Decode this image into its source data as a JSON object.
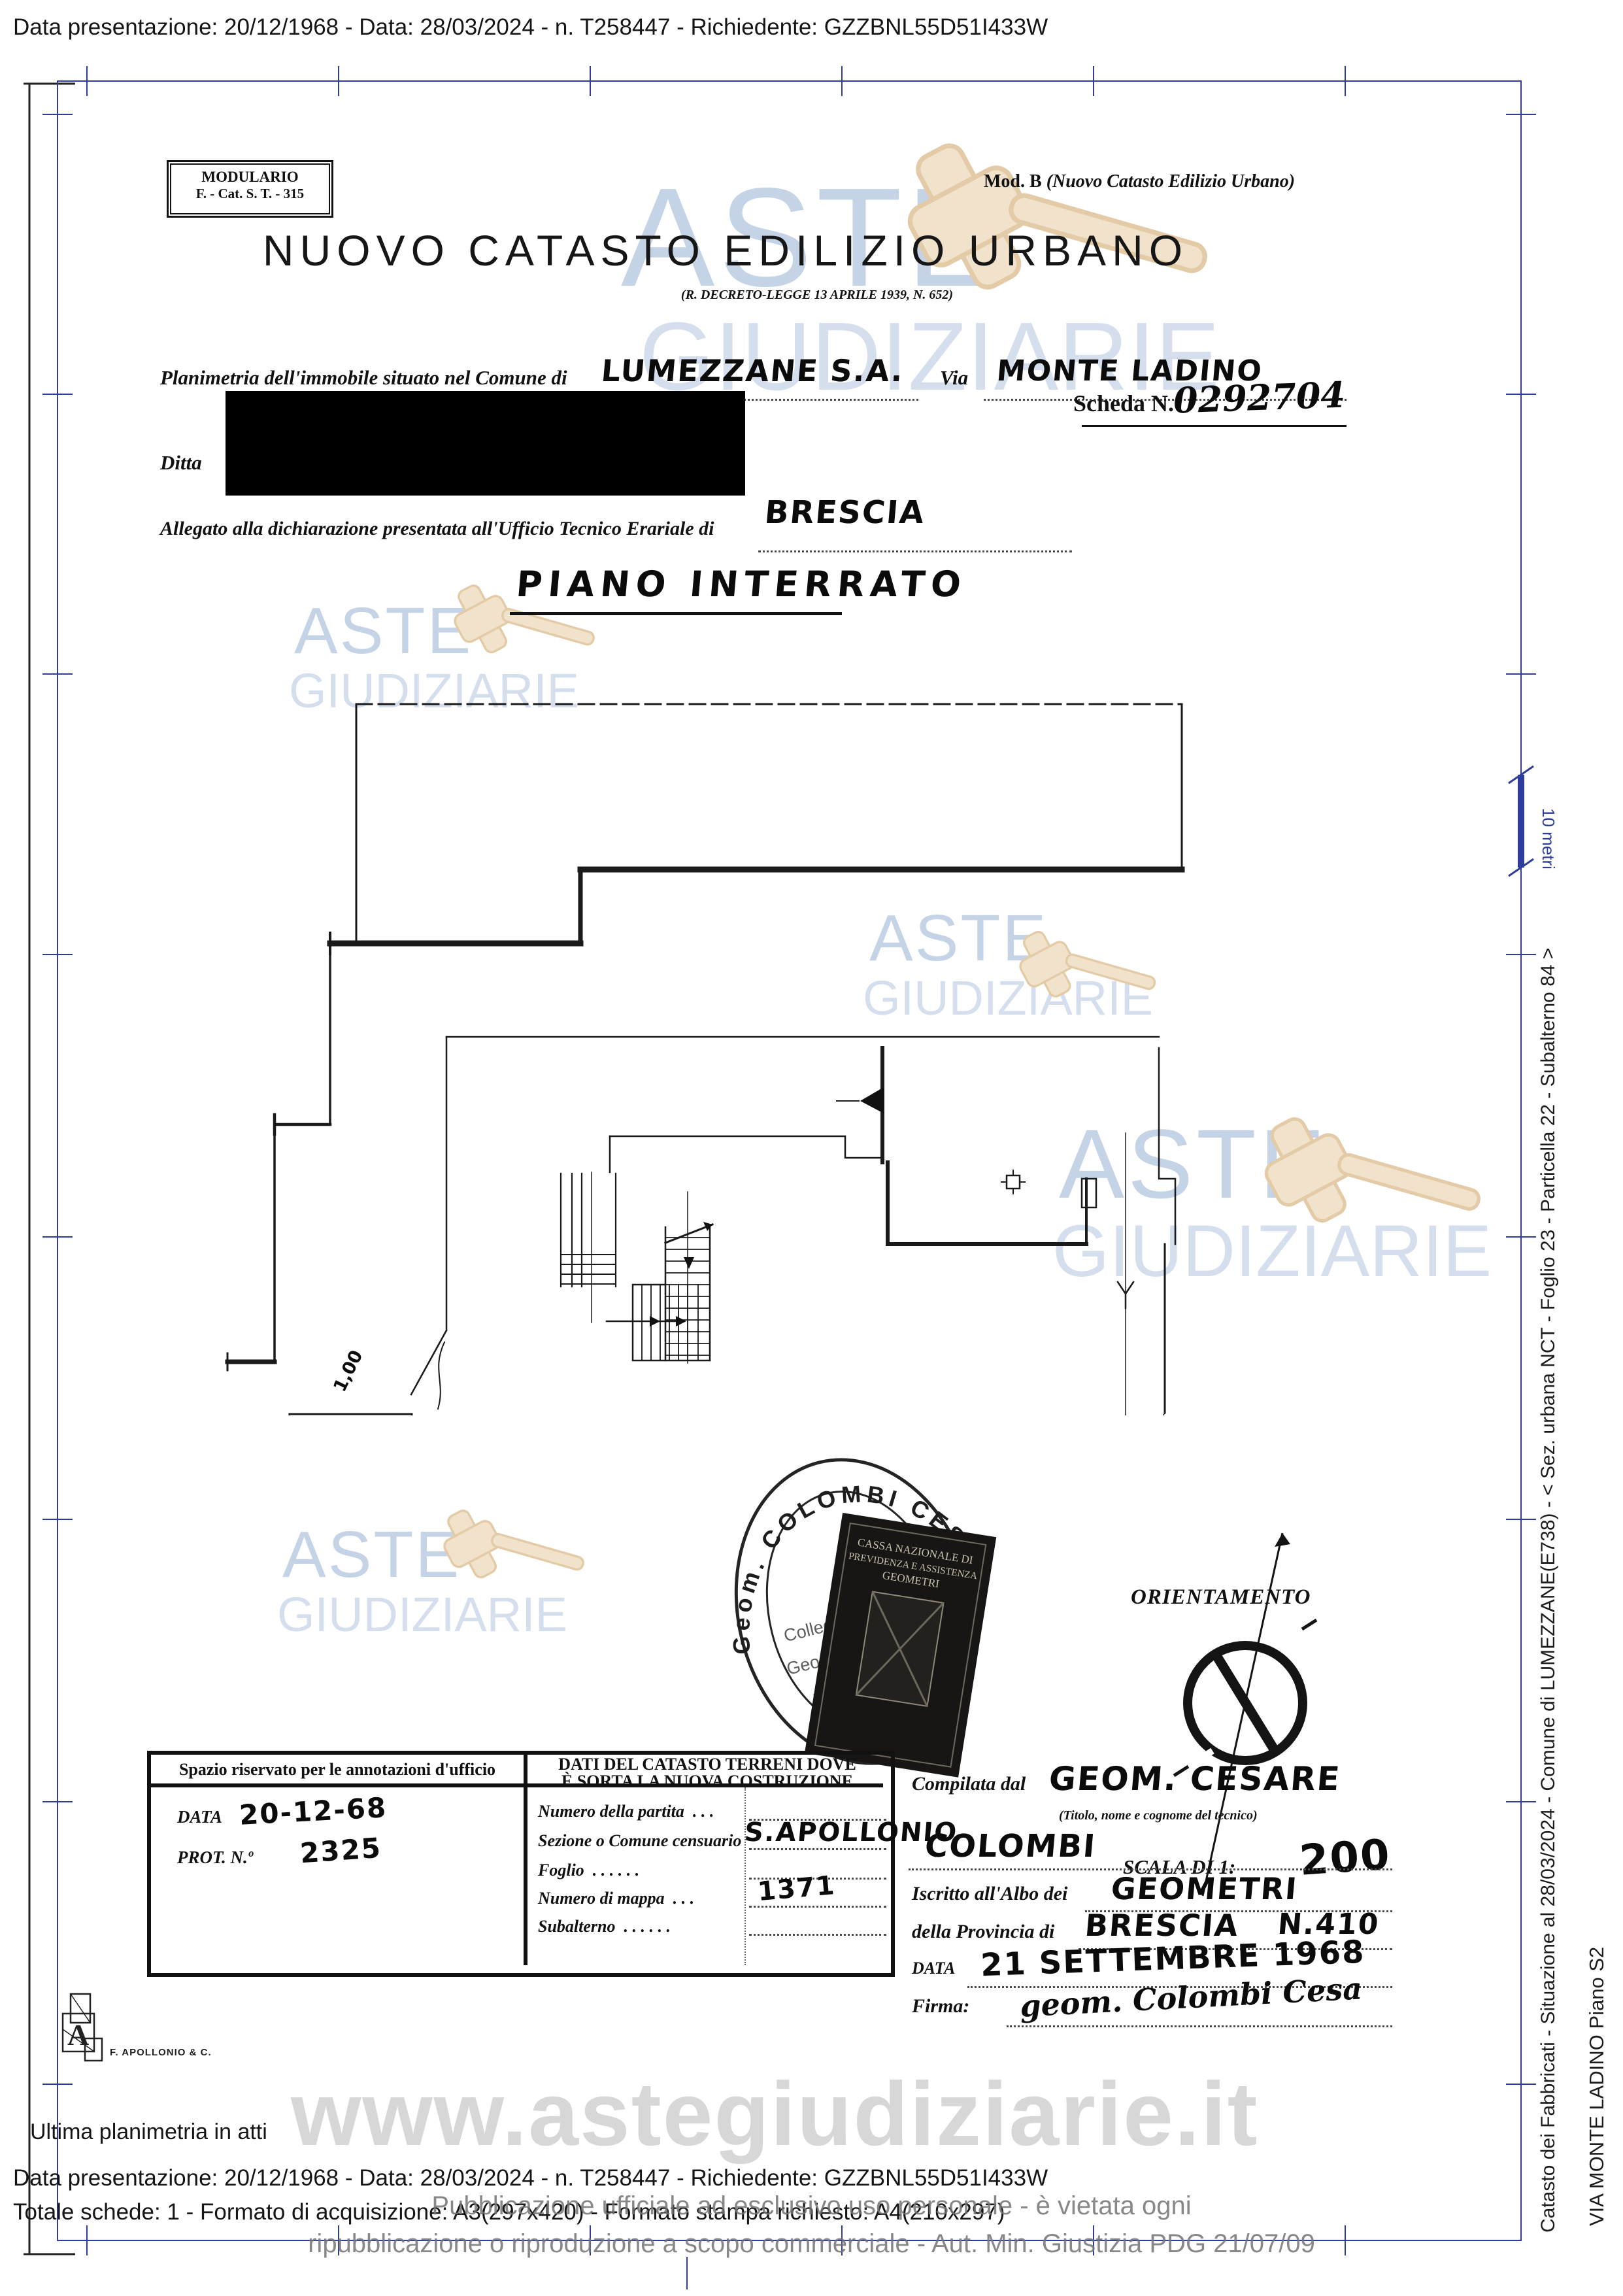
{
  "colors": {
    "frame_blue": "#2e3d9b",
    "watermark_blue": "#9db4d6",
    "gavel_beige": "#f1e2cb",
    "ink": "#111111",
    "footer_gray": "#8e8e8e",
    "url_gray": "#d7d7d7"
  },
  "top_bar": {
    "text": "Data presentazione: 20/12/1968 - Data: 28/03/2024 - n. T258447 - Richiedente: GZZBNL55D51I433W"
  },
  "watermark": {
    "word1": "ASTE",
    "word2": "GIUDIZIARIE",
    "url": "www.astegiudiziarie.it",
    "notice1": "Pubblicazione ufficiale ad esclusivo uso personale - è vietata ogni",
    "notice2": "ripubblicazione o riproduzione a scopo commerciale - Aut. Min. Giustizia PDG 21/07/09"
  },
  "margin_right": {
    "scale_bar_label": "10 metri",
    "cadastre_line": "Catasto dei Fabbricati - Situazione al 28/03/2024 - Comune di LUMEZZANE(E738) - < Sez. urbana NCT - Foglio 23 - Particella 22 - Subalterno 84 >",
    "address_line": "VIA MONTE LADINO Piano S2"
  },
  "form_header": {
    "modulario_line1": "MODULARIO",
    "modulario_line2": "F. - Cat. S. T. - 315",
    "mod_b_prefix": "Mod. B",
    "mod_b_rest": "(Nuovo Catasto Edilizio Urbano)",
    "title": "NUOVO CATASTO EDILIZIO URBANO",
    "subtitle": "(R. DECRETO-LEGGE 13 APRILE 1939, N. 652)"
  },
  "form": {
    "row1_label": "Planimetria dell'immobile situato nel Comune di",
    "row1_value": "LUMEZZANE S.A.",
    "via_label": "Via",
    "via_value": "MONTE LADINO",
    "ditta_label": "Ditta",
    "allegato_label": "Allegato alla dichiarazione presentata all'Ufficio Tecnico Erariale di",
    "allegato_value": "BRESCIA",
    "scheda_label": "Scheda N.",
    "scheda_value": "0292704"
  },
  "plan": {
    "title": "PIANO INTERRATO",
    "labels": {
      "corridoio": "CORRIDOIO",
      "cantina": "CANTINA",
      "height": "H=2,50",
      "dim_top": "1,00",
      "dim_bottom": "2,40",
      "note": "Stessa ditta"
    }
  },
  "stamp": {
    "ring_text": "Geom.  COLOMBI  CES",
    "inner_line1": "Collegio",
    "inner_line2": "Geom",
    "inner_line3": "n.",
    "bollo_line1": "CASSA NAZIONALE DI",
    "bollo_line2": "PREVIDENZA E ASSISTENZA",
    "bollo_line3": "GEOMETRI"
  },
  "orientation": {
    "title": "ORIENTAMENTO",
    "scale_label": "SCALA DI 1:",
    "scale_value": "200"
  },
  "office_table": {
    "left_header": "Spazio riservato per le annotazioni d'ufficio",
    "right_header_line1": "DATI DEL CATASTO TERRENI DOVE",
    "right_header_line2": "È SORTA LA NUOVA COSTRUZIONE",
    "data_label": "DATA",
    "data_value": "20-12-68",
    "prot_label": "PROT. N.º",
    "prot_value": "2325",
    "rows": [
      {
        "label": "Numero della partita",
        "dots": ".   .   .",
        "value": ""
      },
      {
        "label": "Sezione o Comune censuario",
        "dots": "",
        "value": "S.APOLLONIO"
      },
      {
        "label": "Foglio",
        "dots": ".   .   .   .   .   .",
        "value": ""
      },
      {
        "label": "Numero di mappa",
        "dots": ".   .   .",
        "value": "1371"
      },
      {
        "label": "Subalterno",
        "dots": ".   .   .   .   .   .",
        "value": ""
      }
    ],
    "logo_caption": "F. APOLLONIO & C."
  },
  "technician": {
    "compilata_label": "Compilata dal",
    "compilata_value": "GEOM. CESARE",
    "titolo_note": "(Titolo, nome e cognome del tecnico)",
    "surname_value": "COLOMBI",
    "albo_label": "Iscritto all'Albo dei",
    "albo_value": "GEOMETRI",
    "provincia_label": "della Provincia di",
    "provincia_value": "BRESCIA",
    "albo_number": "N.410",
    "data_label": "DATA",
    "data_value": "21 SETTEMBRE 1968",
    "firma_label": "Firma:",
    "firma_value": "geom. Colombi Cesa"
  },
  "footer": {
    "ultima": "Ultima planimetria in atti",
    "line1": "Data presentazione: 20/12/1968 - Data: 28/03/2024 - n. T258447 - Richiedente: GZZBNL55D51I433W",
    "line2": "Totale schede: 1 - Formato di acquisizione: A3(297x420) - Formato stampa richiesto: A4(210x297)"
  }
}
